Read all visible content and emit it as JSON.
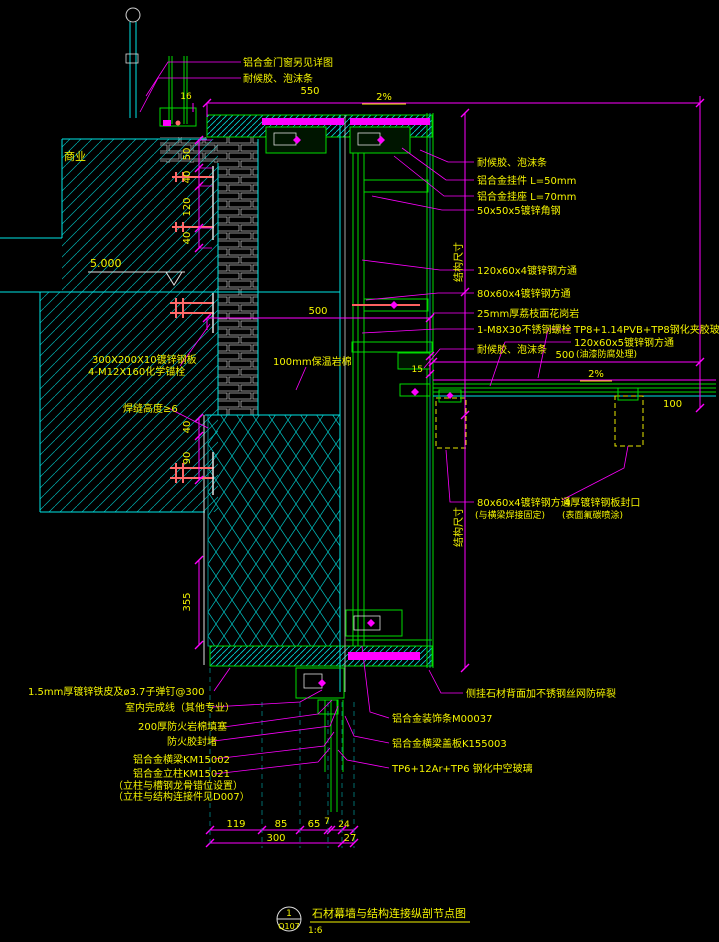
{
  "colors": {
    "background": "#000000",
    "structure_line": "#00e5e5",
    "profile_line": "#00dd00",
    "dimension_line": "#ff00ff",
    "text": "#f5f500",
    "bolt": "#ff6a6a",
    "plate": "#e0e0e0"
  },
  "labels": {
    "top1": "铝合金门窗另见详图",
    "top2": "耐候胶、泡沫条",
    "r1": "耐候胶、泡沫条",
    "r2": "铝合金挂件 L=50mm",
    "r3": "铝合金挂座 L=70mm",
    "r4": "50x50x5镀锌角钢",
    "r5": "120x60x4镀锌钢方通",
    "r6": "80x60x4镀锌钢方通",
    "r7": "25mm厚荔枝面花岗岩",
    "r8": "1-M8X30不锈钢螺栓",
    "r9": "TP8+1.14PVB+TP8钢化夹胶玻璃",
    "r10": "120x60x5镀锌钢方通",
    "r10b": "(油漆防腐处理)",
    "r11": "耐候胶、泡沫条",
    "m1": "80x60x4镀锌钢方通",
    "m1b": "(与横梁焊接固定)",
    "m2": "4厚镀锌钢板封口",
    "m2b": "(表面氟碳喷涂)",
    "zone": "商业",
    "level": "5.000",
    "l3": "300X200X10镀锌钢板",
    "l4": "4-M12X160化学锚栓",
    "l5": "焊缝高度≥6",
    "l6": "100mm保温岩棉",
    "bl1": "1.5mm厚镀锌铁皮及ø3.7子弹钉@300",
    "bl2": "室内完成线（其他专业）",
    "bl3": "200厚防火岩棉填塞",
    "bl4": "防火胶封堵",
    "bl5": "铝合金横梁KM15002",
    "bl6": "铝合金立柱KM15021",
    "bl7": "（立柱与槽钢龙骨错位设置）",
    "bl8": "（立柱与结构连接件见D007）",
    "br1": "侧挂石材背面加不锈钢丝网防碎裂",
    "br2": "铝合金装饰条M00037",
    "br3": "铝合金横梁盖板K155003",
    "br4": "TP6+12Ar+TP6 钢化中空玻璃",
    "struct1": "结构尺寸",
    "struct2": "结构尺寸"
  },
  "dims": {
    "top_width": "550",
    "top_slope": "2%",
    "d16": "16",
    "v50": "50",
    "v40a": "40",
    "v120": "120",
    "v40b": "40",
    "v40c": "40",
    "v90": "90",
    "v355": "355",
    "mid_width": "500",
    "canopy_width": "500",
    "canopy_slope": "2%",
    "d15": "15",
    "canopy_edge": "100",
    "b119": "119",
    "b85": "85",
    "b65": "65",
    "b7": "7",
    "b24": "24",
    "b300": "300",
    "b27": "27"
  },
  "title_block": {
    "detail_no": "1",
    "sheet_ref": "Q107",
    "title": "石材幕墙与结构连接纵剖节点图",
    "scale": "1:6"
  }
}
